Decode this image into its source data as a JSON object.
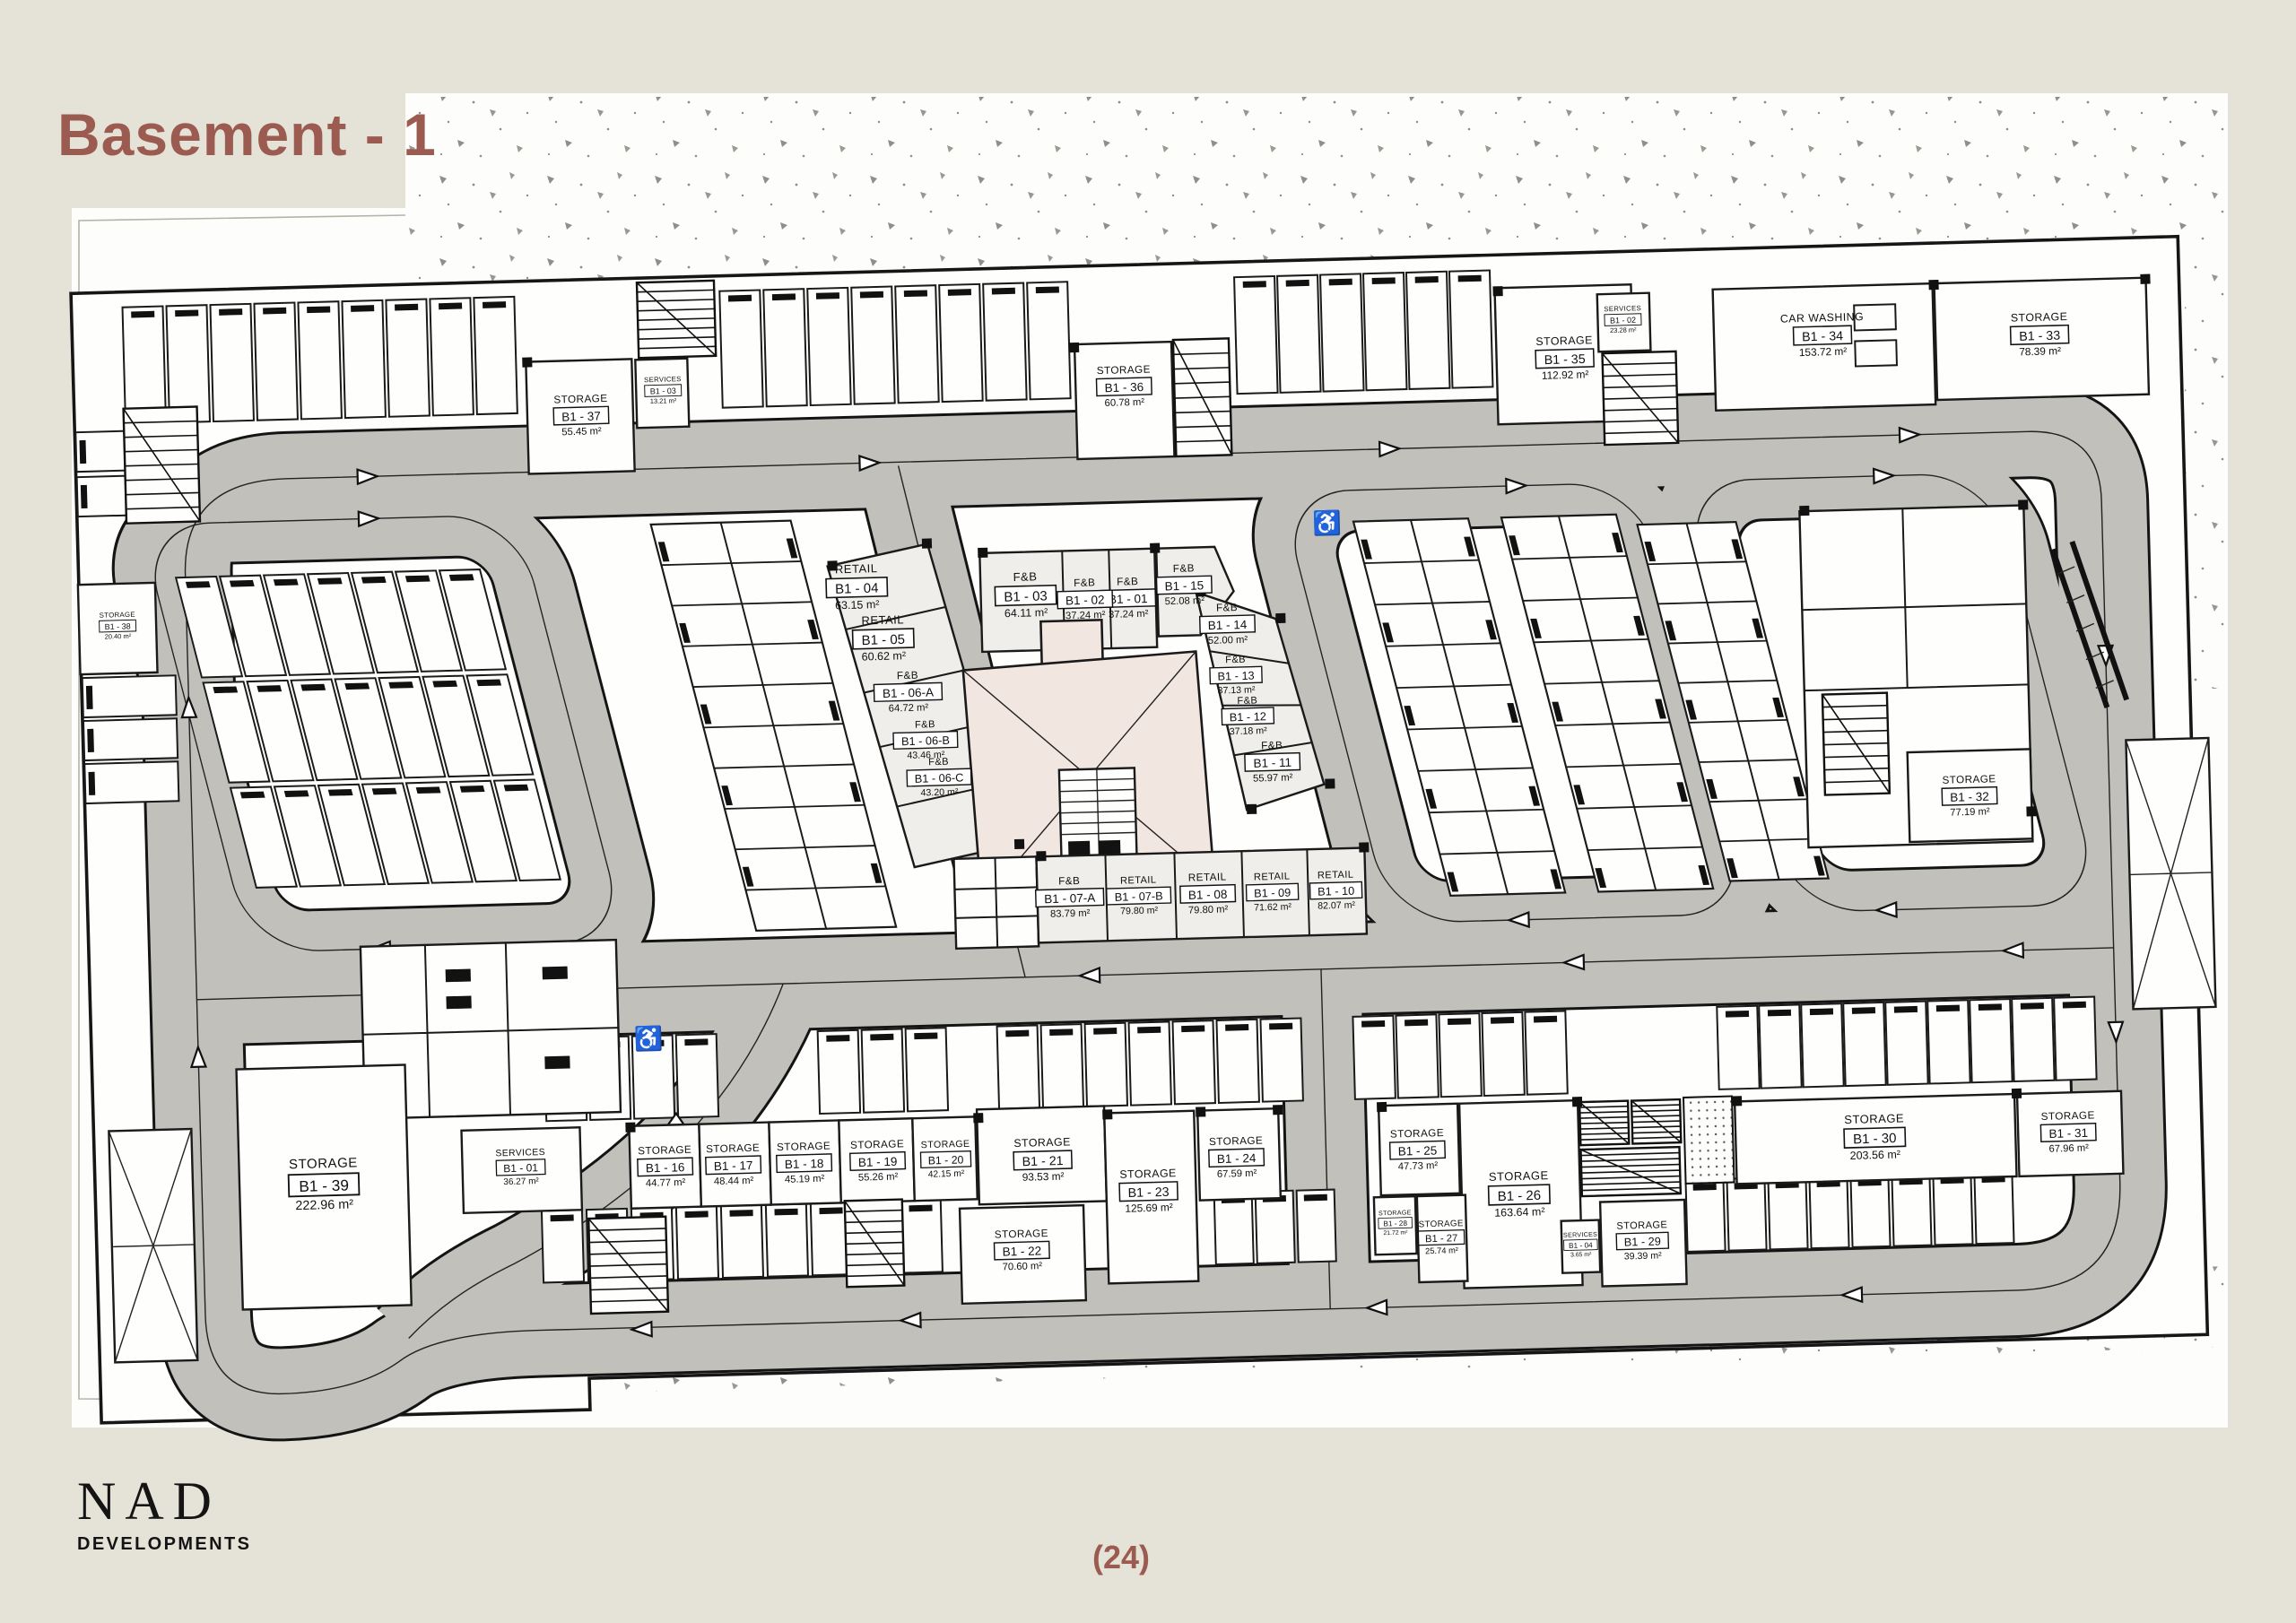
{
  "page": {
    "title": "Basement - 1",
    "page_number": "(24)",
    "logo": {
      "name": "NAD",
      "subtitle": "DEVELOPMENTS"
    }
  },
  "colors": {
    "accent": "#9C5B51",
    "paper": "#E5E3D7",
    "sheet": "#FDFDFB",
    "road": "#C2C0BB",
    "unit_fill": "#EFEEEA",
    "core_fill": "#F2E7E0",
    "line": "#1A1A1A"
  },
  "units": [
    {
      "key": "b101",
      "use": "F&B",
      "id": "B1 - 01",
      "area": "37.24 m²"
    },
    {
      "key": "b102",
      "use": "F&B",
      "id": "B1 - 02",
      "area": "37.24 m²"
    },
    {
      "key": "b103",
      "use": "F&B",
      "id": "B1 - 03",
      "area": "64.11 m²"
    },
    {
      "key": "b104",
      "use": "RETAIL",
      "id": "B1 - 04",
      "area": "63.15 m²"
    },
    {
      "key": "b105",
      "use": "RETAIL",
      "id": "B1 - 05",
      "area": "60.62 m²"
    },
    {
      "key": "b106a",
      "use": "F&B",
      "id": "B1 - 06-A",
      "area": "64.72 m²"
    },
    {
      "key": "b106b",
      "use": "F&B",
      "id": "B1 - 06-B",
      "area": "43.46 m²"
    },
    {
      "key": "b106c",
      "use": "F&B",
      "id": "B1 - 06-C",
      "area": "43.20 m²"
    },
    {
      "key": "b107a",
      "use": "F&B",
      "id": "B1 - 07-A",
      "area": "83.79 m²"
    },
    {
      "key": "b107b",
      "use": "RETAIL",
      "id": "B1 - 07-B",
      "area": "79.80 m²"
    },
    {
      "key": "b108",
      "use": "RETAIL",
      "id": "B1 - 08",
      "area": "79.80 m²"
    },
    {
      "key": "b109",
      "use": "RETAIL",
      "id": "B1 - 09",
      "area": "71.62 m²"
    },
    {
      "key": "b110",
      "use": "RETAIL",
      "id": "B1 - 10",
      "area": "82.07 m²"
    },
    {
      "key": "b111",
      "use": "F&B",
      "id": "B1 - 11",
      "area": "55.97 m²"
    },
    {
      "key": "b112",
      "use": "F&B",
      "id": "B1 - 12",
      "area": "37.18 m²"
    },
    {
      "key": "b113",
      "use": "F&B",
      "id": "B1 - 13",
      "area": "37.13 m²"
    },
    {
      "key": "b114",
      "use": "F&B",
      "id": "B1 - 14",
      "area": "52.00 m²"
    },
    {
      "key": "b115",
      "use": "F&B",
      "id": "B1 - 15",
      "area": "52.08 m²"
    },
    {
      "key": "b116",
      "use": "STORAGE",
      "id": "B1 - 16",
      "area": "44.77 m²"
    },
    {
      "key": "b117",
      "use": "STORAGE",
      "id": "B1 - 17",
      "area": "48.44 m²"
    },
    {
      "key": "b118",
      "use": "STORAGE",
      "id": "B1 - 18",
      "area": "45.19 m²"
    },
    {
      "key": "b119",
      "use": "STORAGE",
      "id": "B1 - 19",
      "area": "55.26 m²"
    },
    {
      "key": "b120",
      "use": "STORAGE",
      "id": "B1 - 20",
      "area": "42.15 m²"
    },
    {
      "key": "b121",
      "use": "STORAGE",
      "id": "B1 - 21",
      "area": "93.53 m²"
    },
    {
      "key": "b122",
      "use": "STORAGE",
      "id": "B1 - 22",
      "area": "70.60 m²"
    },
    {
      "key": "b123",
      "use": "STORAGE",
      "id": "B1 - 23",
      "area": "125.69 m²"
    },
    {
      "key": "b124",
      "use": "STORAGE",
      "id": "B1 - 24",
      "area": "67.59 m²"
    },
    {
      "key": "b125",
      "use": "STORAGE",
      "id": "B1 - 25",
      "area": "47.73 m²"
    },
    {
      "key": "b126",
      "use": "STORAGE",
      "id": "B1 - 26",
      "area": "163.64 m²"
    },
    {
      "key": "b127",
      "use": "STORAGE",
      "id": "B1 - 27",
      "area": "25.74 m²"
    },
    {
      "key": "b128",
      "use": "STORAGE",
      "id": "B1 - 28",
      "area": "21.72 m²"
    },
    {
      "key": "b129",
      "use": "STORAGE",
      "id": "B1 - 29",
      "area": "39.39 m²"
    },
    {
      "key": "b130",
      "use": "STORAGE",
      "id": "B1 - 30",
      "area": "203.56 m²"
    },
    {
      "key": "b131",
      "use": "STORAGE",
      "id": "B1 - 31",
      "area": "67.96 m²"
    },
    {
      "key": "b132",
      "use": "STORAGE",
      "id": "B1 - 32",
      "area": "77.19 m²"
    },
    {
      "key": "b133",
      "use": "STORAGE",
      "id": "B1 - 33",
      "area": "78.39 m²"
    },
    {
      "key": "b134",
      "use": "CAR WASHING",
      "id": "B1 - 34",
      "area": "153.72 m²"
    },
    {
      "key": "b135",
      "use": "STORAGE",
      "id": "B1 - 35",
      "area": "112.92 m²"
    },
    {
      "key": "b136",
      "use": "STORAGE",
      "id": "B1 - 36",
      "area": "60.78 m²"
    },
    {
      "key": "b137",
      "use": "STORAGE",
      "id": "B1 - 37",
      "area": "55.45 m²"
    },
    {
      "key": "b138",
      "use": "STORAGE",
      "id": "B1 - 38",
      "area": "20.40 m²"
    },
    {
      "key": "b139",
      "use": "STORAGE",
      "id": "B1 - 39",
      "area": "222.96 m²"
    },
    {
      "key": "svc01",
      "use": "SERVICES",
      "id": "B1 - 01",
      "area": "36.27 m²"
    },
    {
      "key": "svc02",
      "use": "SERVICES",
      "id": "B1 - 02",
      "area": "23.28 m²"
    },
    {
      "key": "svc03",
      "use": "SERVICES",
      "id": "B1 - 03",
      "area": "13.21 m²"
    },
    {
      "key": "svc04",
      "use": "SERVICES",
      "id": "B1 - 04",
      "area": "3.65 m²"
    }
  ]
}
